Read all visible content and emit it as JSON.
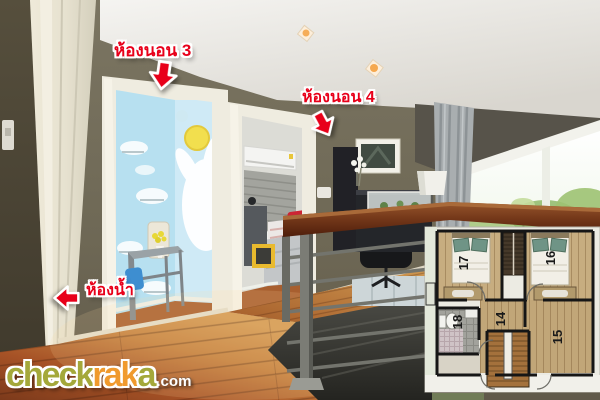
{
  "annotations": {
    "label_color": "#e8001a",
    "bedroom3": {
      "label": "ห้องนอน 3",
      "arrow_icon": "arrow-down"
    },
    "bedroom4": {
      "label": "ห้องนอน 4",
      "arrow_icon": "arrow-down"
    },
    "bathroom": {
      "label": "ห้องน้ำ",
      "arrow_icon": "arrow-left"
    }
  },
  "floor_plan": {
    "room_numbers": {
      "bedroom_left": "17",
      "bedroom_right": "16",
      "bathroom": "18",
      "hall": "14",
      "family_room": "15"
    }
  },
  "watermark": {
    "brand_parts": {
      "check": "check",
      "rak": "rak",
      "a": "a"
    },
    "tld": ".com",
    "brand_colors": {
      "check": "#a4a83a",
      "rak": "#f09a2e",
      "a": "#a4a83a",
      "tld": "#ffffff"
    }
  }
}
